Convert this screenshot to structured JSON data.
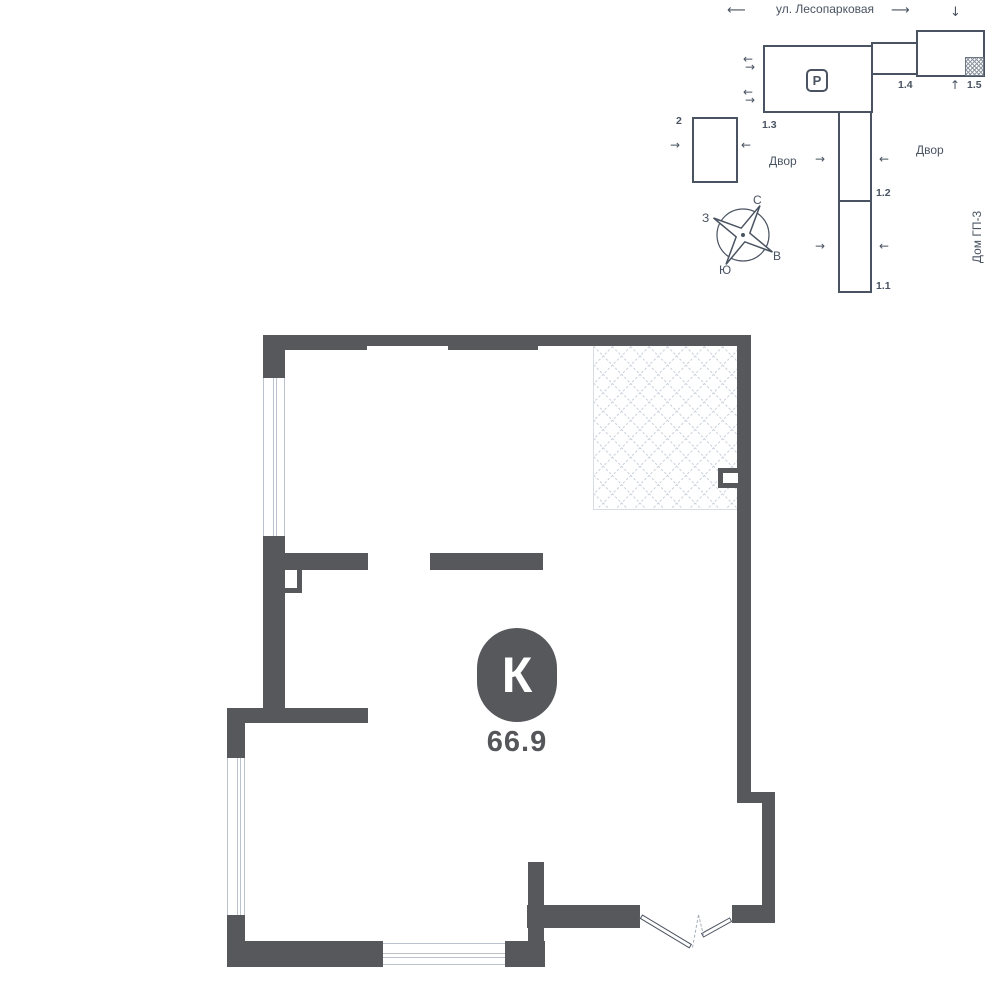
{
  "site_plan": {
    "street_label": "ул. Лесопарковая",
    "parking_label": "Р",
    "courtyard_left": "Двор",
    "courtyard_right": "Двор",
    "house_label": "Дом ГП-3",
    "building_labels": {
      "b2": "2",
      "b13": "1.3",
      "b14": "1.4",
      "b15": "1.5",
      "b12": "1.2",
      "b11": "1.1"
    },
    "compass": {
      "north": "С",
      "south": "Ю",
      "west": "З",
      "east": "В"
    }
  },
  "floor_plan": {
    "unit_type_letter": "К",
    "area": "66.9"
  },
  "icons": {
    "arrow_left": "⟵",
    "arrow_right": "⟶",
    "arrow_left_sm": "←",
    "arrow_right_sm": "→",
    "arrow_up": "↑",
    "arrow_down": "↓"
  },
  "colors": {
    "wall": "#57585c",
    "line": "#4a5361"
  }
}
